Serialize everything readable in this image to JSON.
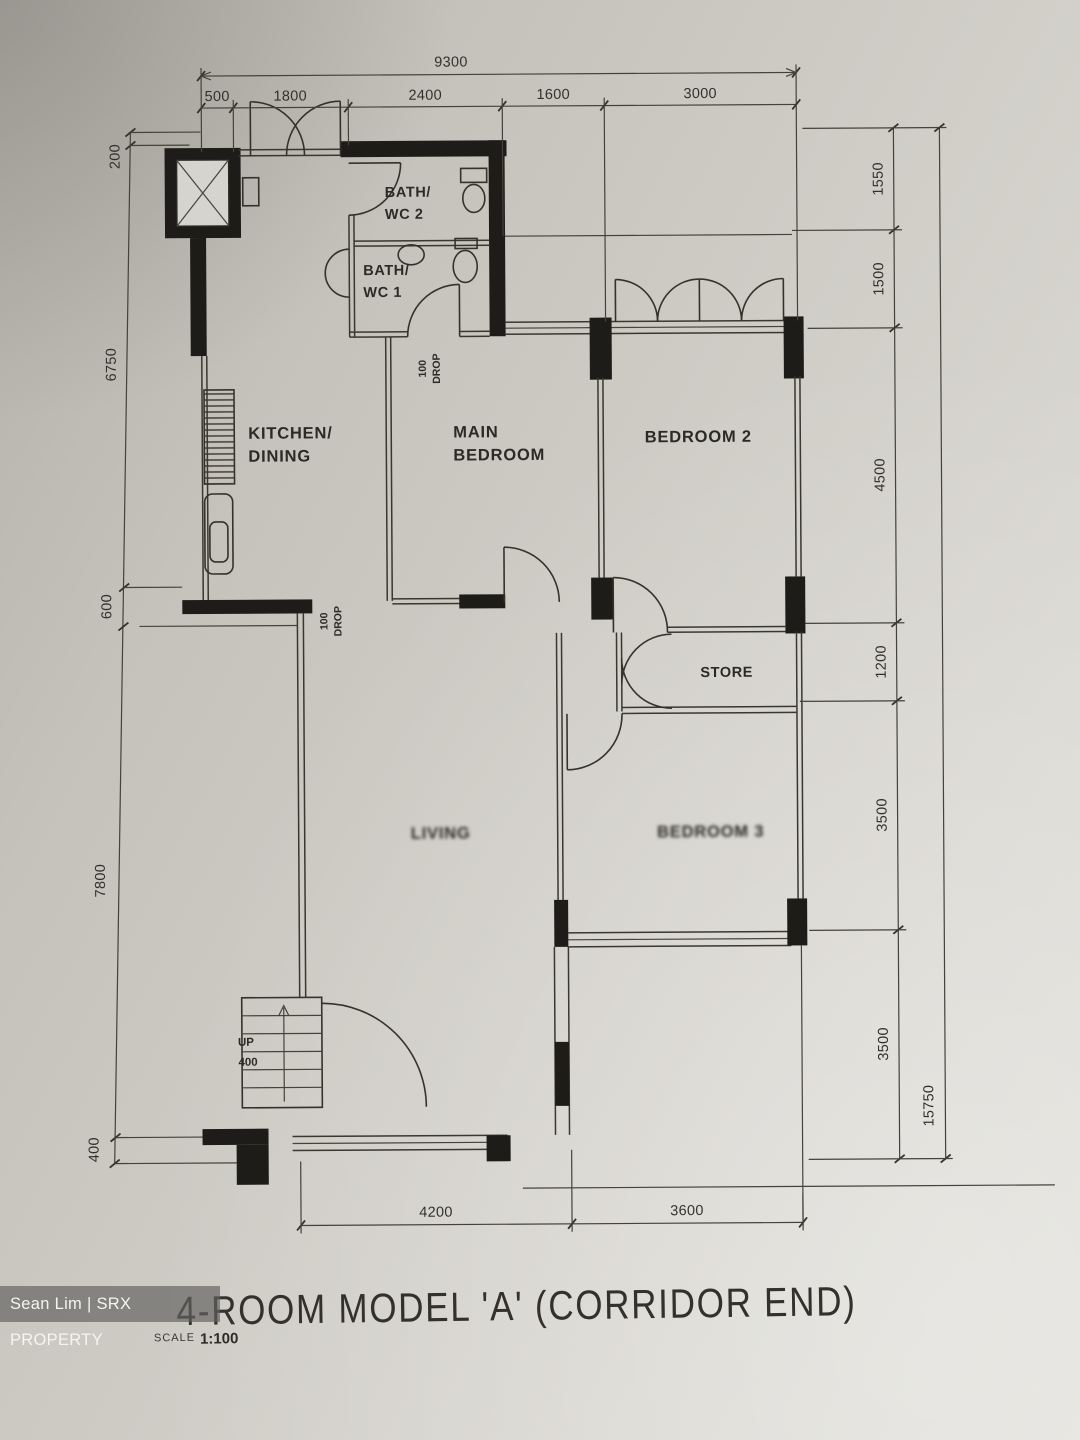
{
  "watermark": {
    "text": "Sean Lim | SRX PROPERTY"
  },
  "title": {
    "text": "4-ROOM MODEL 'A' (CORRIDOR END)",
    "scale_label": "SCALE",
    "scale_value": "1:100"
  },
  "rooms": {
    "bath_wc2": {
      "line1": "BATH/",
      "line2": "WC 2"
    },
    "bath_wc1": {
      "line1": "BATH/",
      "line2": "WC 1"
    },
    "kitchen": {
      "line1": "KITCHEN/",
      "line2": "DINING"
    },
    "main_bedroom": {
      "line1": "MAIN",
      "line2": "BEDROOM"
    },
    "bedroom2": {
      "label": "BEDROOM 2"
    },
    "store": {
      "label": "STORE"
    },
    "living": {
      "label": "LIVING"
    },
    "bedroom3": {
      "label": "BEDROOM 3"
    }
  },
  "annotations": {
    "drop1": {
      "line1": "100",
      "line2": "DROP"
    },
    "drop2": {
      "line1": "100",
      "line2": "DROP"
    },
    "stair_up": "UP",
    "stair_rise": "400"
  },
  "dimensions": {
    "top_overall": "9300",
    "top_segments": [
      "500",
      "1800",
      "2400",
      "1600",
      "3000"
    ],
    "left_segments": [
      "200",
      "6750",
      "600",
      "7800",
      "400"
    ],
    "right_segments": [
      "1550",
      "1500",
      "4500",
      "1200",
      "3500",
      "3500"
    ],
    "right_overall": "15750",
    "bottom_segments": [
      "4200",
      "3600"
    ]
  }
}
